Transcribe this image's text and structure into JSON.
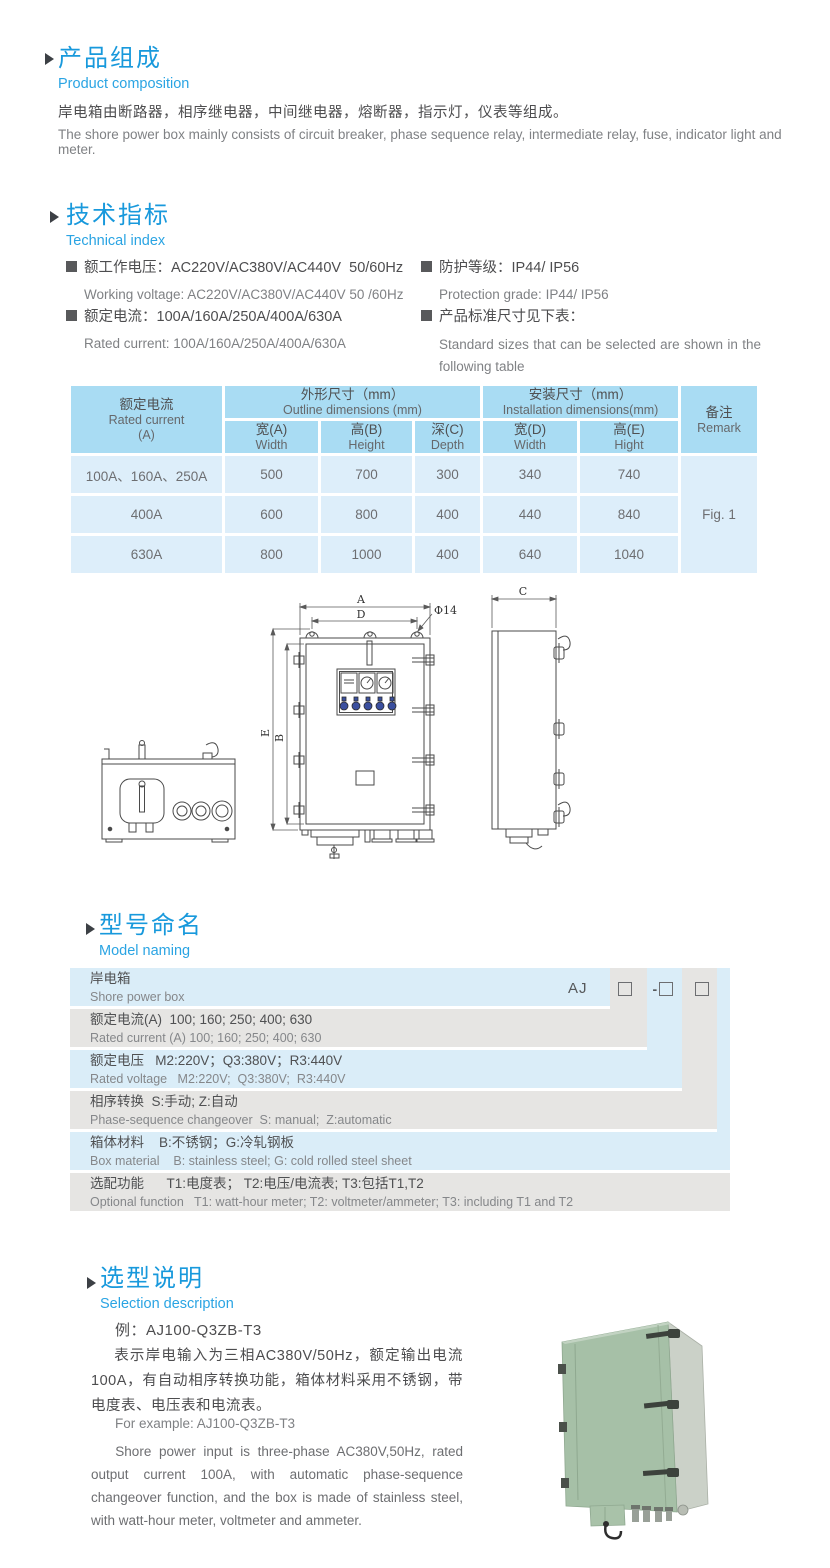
{
  "colors": {
    "accent": "#1899dc",
    "table_header_bg": "#a9dcf3",
    "table_body_bg": "#ddeefa",
    "naming_blue": "#daedf8",
    "naming_gray": "#e6e5e3"
  },
  "composition": {
    "title_zh": "产品组成",
    "title_en": "Product  composition",
    "body_zh": "岸电箱由断路器，相序继电器，中间继电器，熔断器，指示灯，仪表等组成。",
    "body_en": "The shore power box mainly consists of circuit breaker, phase sequence relay, intermediate relay, fuse, indicator light and meter."
  },
  "technical": {
    "title_zh": "技术指标",
    "title_en": "Technical index",
    "specs": [
      {
        "zh": "额工作电压：AC220V/AC380V/AC440V  50/60Hz",
        "en": "Working voltage: AC220V/AC380V/AC440V 50 /60Hz"
      },
      {
        "zh": "额定电流：100A/160A/250A/400A/630A",
        "en": "Rated current: 100A/160A/250A/400A/630A"
      },
      {
        "zh": "防护等级：IP44/ IP56",
        "en": "Protection grade: IP44/ IP56"
      },
      {
        "zh": "产品标准尺寸见下表：",
        "en": "Standard sizes that can be selected are shown in the following table"
      }
    ]
  },
  "size_table": {
    "rated_current_zh": "额定电流",
    "rated_current_en": "Rated current",
    "rated_current_unit": "(A)",
    "outline_zh": "外形尺寸（mm）",
    "outline_en": "Outline dimensions (mm)",
    "install_zh": "安装尺寸（mm）",
    "install_en": "Installation dimensions(mm)",
    "remark_zh": "备注",
    "remark_en": "Remark",
    "columns": [
      {
        "zh": "宽(A)",
        "en": "Width"
      },
      {
        "zh": "高(B)",
        "en": "Height"
      },
      {
        "zh": "深(C)",
        "en": "Depth"
      },
      {
        "zh": "宽(D)",
        "en": "Width"
      },
      {
        "zh": "高(E)",
        "en": "Hight"
      }
    ],
    "rows": [
      {
        "current": "100A、160A、250A",
        "width_a": "500",
        "height_b": "700",
        "depth_c": "300",
        "width_d": "340",
        "height_e": "740"
      },
      {
        "current": "400A",
        "width_a": "600",
        "height_b": "800",
        "depth_c": "400",
        "width_d": "440",
        "height_e": "840"
      },
      {
        "current": "630A",
        "width_a": "800",
        "height_b": "1000",
        "depth_c": "400",
        "width_d": "640",
        "height_e": "1040"
      }
    ],
    "remark_value": "Fig. 1"
  },
  "drawing": {
    "labels": {
      "a": "A",
      "b": "B",
      "c": "C",
      "d": "D",
      "e": "E",
      "hole": "Φ14"
    }
  },
  "model_naming": {
    "title_zh": "型号命名",
    "title_en": "Model naming",
    "code_prefix": "AJ",
    "code_separator": "-",
    "rows": [
      {
        "zh": "岸电箱",
        "en": "Shore power box"
      },
      {
        "zh": "额定电流(A)  100; 160; 250; 400; 630",
        "en": "Rated current (A) 100; 160; 250; 400; 630"
      },
      {
        "zh": "额定电压   M2:220V；Q3:380V；R3:440V",
        "en": "Rated voltage   M2:220V;  Q3:380V;  R3:440V"
      },
      {
        "zh": "相序转换  S:手动; Z:自动",
        "en": "Phase-sequence changeover  S: manual;  Z:automatic"
      },
      {
        "zh": "箱体材料    B:不锈钢；G:冷轧钢板",
        "en": "Box material    B: stainless steel; G: cold rolled steel sheet"
      },
      {
        "zh": "选配功能      T1:电度表； T2:电压/电流表; T3:包括T1,T2",
        "en": "Optional function   T1: watt-hour meter; T2: voltmeter/ammeter; T3: including T1 and T2"
      }
    ]
  },
  "selection": {
    "title_zh": "选型说明",
    "title_en": "Selection description",
    "example_zh": "例：AJ100-Q3ZB-T3",
    "para_zh": "表示岸电输入为三相AC380V/50Hz，额定输出电流100A，有自动相序转换功能，箱体材料采用不锈钢，带电度表、电压表和电流表。",
    "example_en": "For example: AJ100-Q3ZB-T3",
    "para_en": "Shore power input is three-phase AC380V,50Hz, rated output current 100A, with automatic phase-sequence changeover function, and the box is made of stainless steel, with watt-hour meter, voltmeter and ammeter."
  }
}
